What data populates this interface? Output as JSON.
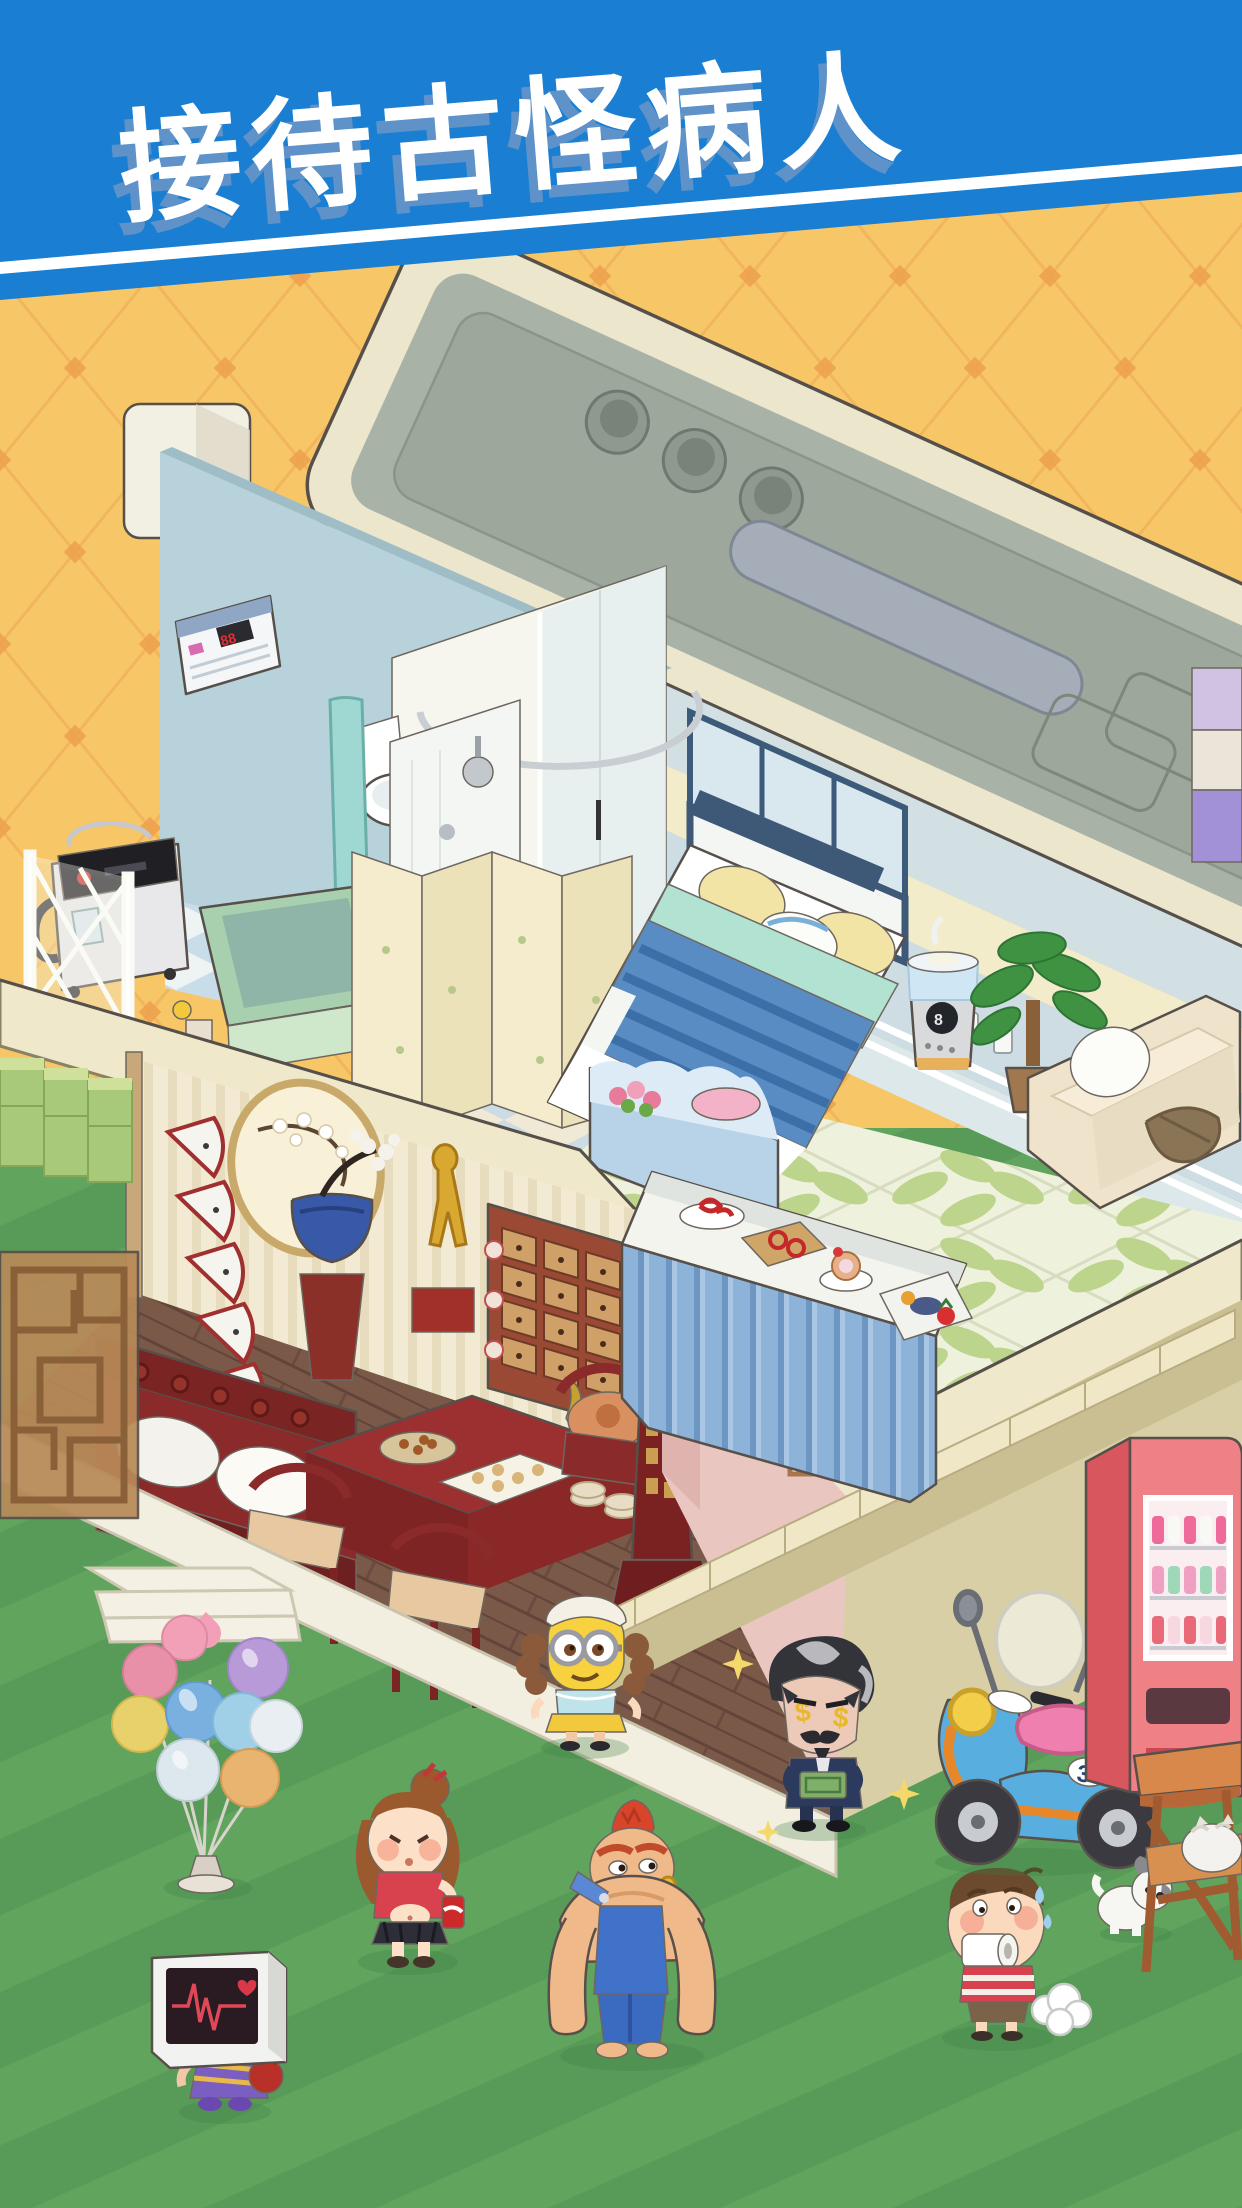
{
  "banner": {
    "title": "接待古怪病人",
    "background": "#1a7fd2",
    "stripe_color": "#ffffff",
    "text_color": "#ffffff",
    "text_shadow": "#5e92c8"
  },
  "palette": {
    "wallpaper": "#f7c667",
    "wallpaper_line": "#eda04e",
    "grass": "#60a45e",
    "grass_dark": "#589b58",
    "roof_top": "#a9b2a6",
    "roof_fascia": "#ebe6cc",
    "floor_slab": "#efe8cb",
    "chinese_wall": "#f3ead3",
    "chinese_floor": "#7b5948",
    "pink_wall": "#e9c6c0",
    "exterior_wall": "#d8cfa6",
    "bath_wall": "#b7d2da",
    "living_wall_blue": "#cddde3",
    "living_wall_cream": "#f2ecca"
  },
  "upper_floor": {
    "bathroom": {
      "air_conditioner": "wall-mounted white unit with red digits",
      "bathtub_color": "#a8cfae",
      "toilet_color": "#ffffff",
      "washing_machine": "silver top-load with black control panel",
      "shower": "curved chrome curtain rail with teal curtain"
    },
    "bedroom": {
      "duvet_color": "#5a8cc4",
      "throw_color": "#b2e2d2",
      "pillow_color": "#f2e4a4",
      "headboard_color": "#3e5878",
      "foot_chest": "light blue with pink towel and flowers"
    },
    "living": {
      "sofa_color": "#efe3cc",
      "sofa_pillow": "#ffffff",
      "sofa_bolster": "#8a7456",
      "plant": "potted green plant",
      "humidifier": "white-silver with digital display"
    }
  },
  "lower_floor": {
    "chinese_room": {
      "wall_fans": 5,
      "moon_window": "round window with plum blossom branch",
      "bonsai_pot_color": "#3858a8",
      "statue": "golden acupuncture figure on red base",
      "medicine_cabinet": "wooden drawer cabinet 4x5",
      "sofa_color": "#7a2424",
      "table_items": [
        "snack plate",
        "dumpling mat",
        "gold vase",
        "covered bowl",
        "dish stacks"
      ],
      "incense_burner": "red pagoda burner with smoke"
    },
    "stair_hall": {
      "wall_color": "#e9c6c0",
      "framed_pictures": 2,
      "stairs_color": "#efe7c6"
    }
  },
  "ground": {
    "balloon_stand": {
      "balloon_colors": [
        "#f2a0b8",
        "#b89ad8",
        "#e890a8",
        "#e8d06a",
        "#7ab0e0",
        "#9fd0e8",
        "#e8eef2",
        "#dde8ee",
        "#e8b470"
      ]
    },
    "characters": [
      {
        "name": "monitor-head-patient",
        "desc": "patient whose head is an ECG monitor, purple dress, red handbag"
      },
      {
        "name": "cola-girl",
        "desc": "girl with brown bun hair drinking a red soda can"
      },
      {
        "name": "minion-maid",
        "desc": "yellow goggled character in maid cap with brown pigtails"
      },
      {
        "name": "mohawk-strongman",
        "desc": "hulking man with red mohawk and blue overalls"
      },
      {
        "name": "money-vampire",
        "desc": "vampire in navy suit with dollar-sign eyes holding cash"
      },
      {
        "name": "toilet-paper-boy",
        "desc": "sweating boy biting a toilet paper roll, striped shirt, fart cloud"
      }
    ],
    "pets": [
      {
        "name": "puppy",
        "color": "white with gray ears"
      },
      {
        "name": "cat",
        "color": "white fluffy, on wooden bench"
      }
    ],
    "scooter": {
      "plate": "37",
      "body_color": "#58aede",
      "seat_color": "#ee7fae",
      "basket": "wicker"
    },
    "vending_machine": {
      "color": "#ef8086",
      "contents": "pink and white drinks"
    },
    "ecg_monitor": {
      "screen": "#2a1b22",
      "trace_color": "#e04858",
      "heart_icon": "red heart"
    }
  }
}
